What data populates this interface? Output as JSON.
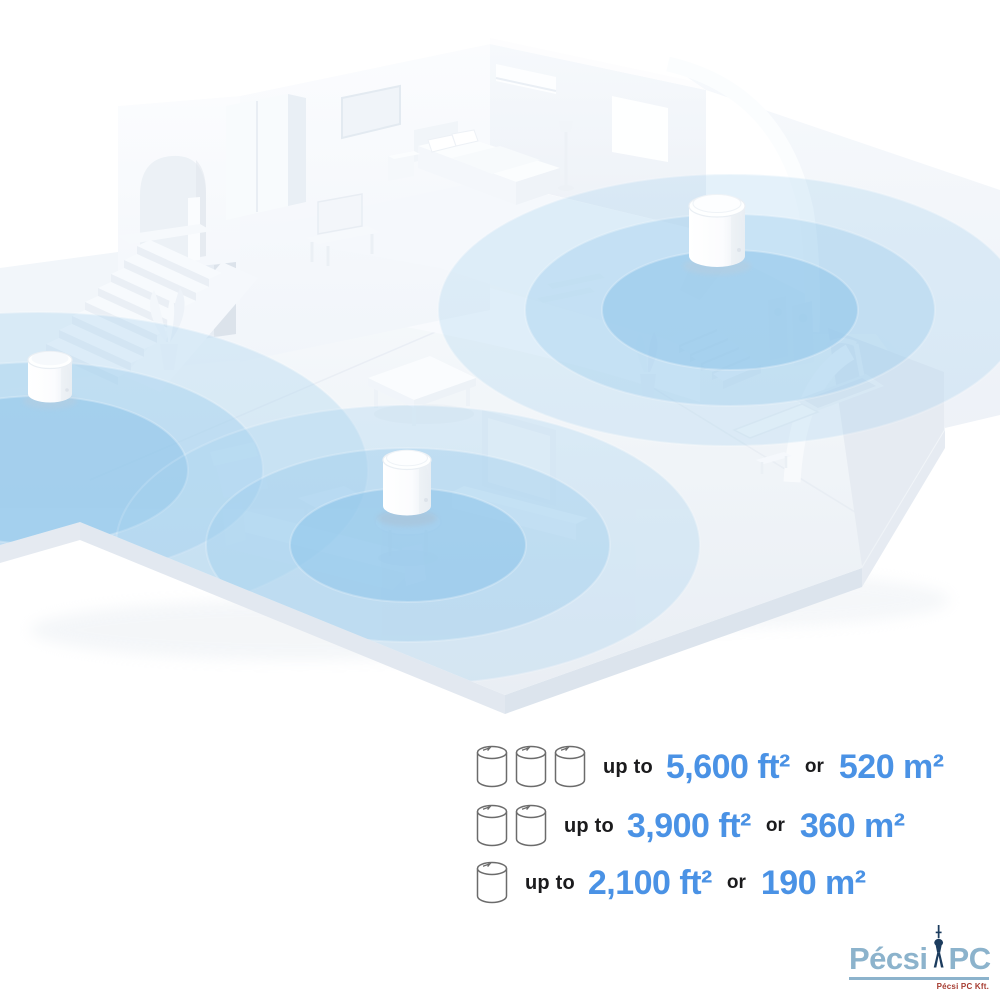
{
  "illustration": {
    "name": "mesh-wifi-home-coverage",
    "description": "Isometric white home interior with three mesh Wi-Fi units emitting blue coverage circles",
    "unit_count": 3
  },
  "coverage_rows": [
    {
      "units": 3,
      "prefix": "up to",
      "imperial": "5,600 ft²",
      "conjunction": "or",
      "metric": "520 m²"
    },
    {
      "units": 2,
      "prefix": "up to",
      "imperial": "3,900 ft²",
      "conjunction": "or",
      "metric": "360 m²"
    },
    {
      "units": 1,
      "prefix": "up to",
      "imperial": "2,100 ft²",
      "conjunction": "or",
      "metric": "190 m²"
    }
  ],
  "watermark": {
    "brand_part1": "Pécsi",
    "brand_part2": "PC",
    "tagline": "Pécsi PC Kft."
  },
  "colors": {
    "value_blue": "#4A92E5",
    "label_dark": "#1B1B1D",
    "coverage_blue": "#8FC6EC",
    "logo_blue": "#8CB3CC",
    "logo_navy": "#1C3C5E",
    "logo_red": "#A63B30"
  }
}
